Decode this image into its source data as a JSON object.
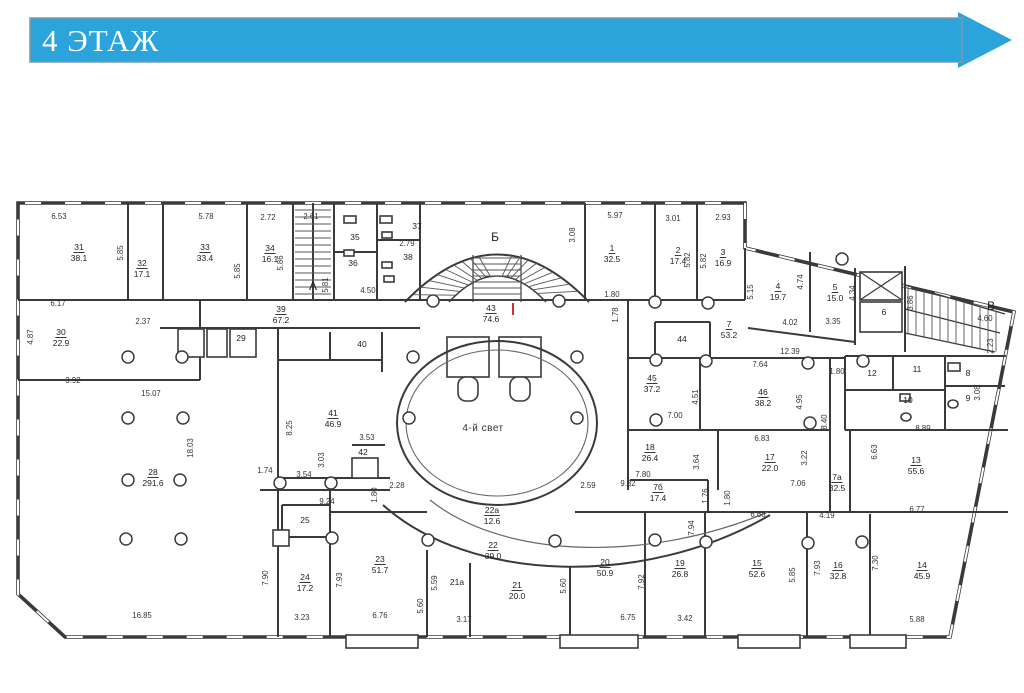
{
  "header": {
    "title": "4 ЭТАЖ",
    "bg_color": "#2AA4DA",
    "border_color": "#7D9AAB",
    "text_color": "#ffffff"
  },
  "plan": {
    "atrium_label": "4-й свет",
    "red_mark": {
      "x": 513,
      "y": 303
    },
    "stairs": [
      {
        "label": "А",
        "x": 313,
        "y": 290
      },
      {
        "label": "Б",
        "x": 495,
        "y": 241
      },
      {
        "label": "В",
        "x": 991,
        "y": 310
      }
    ],
    "rooms": [
      {
        "n": "31",
        "a": "38.1",
        "x": 79,
        "y": 250
      },
      {
        "n": "32",
        "a": "17.1",
        "x": 142,
        "y": 266
      },
      {
        "n": "33",
        "a": "33.4",
        "x": 205,
        "y": 250
      },
      {
        "n": "34",
        "a": "16.1",
        "x": 270,
        "y": 251
      },
      {
        "n": "35",
        "x": 355,
        "y": 240
      },
      {
        "n": "36",
        "x": 353,
        "y": 266
      },
      {
        "n": "37",
        "x": 417,
        "y": 229
      },
      {
        "n": "38",
        "x": 408,
        "y": 260
      },
      {
        "n": "39",
        "a": "67.2",
        "x": 281,
        "y": 312
      },
      {
        "n": "40",
        "x": 362,
        "y": 347
      },
      {
        "n": "41",
        "a": "46.9",
        "x": 333,
        "y": 416
      },
      {
        "n": "42",
        "x": 363,
        "y": 455
      },
      {
        "n": "43",
        "a": "74.6",
        "x": 491,
        "y": 311
      },
      {
        "n": "44",
        "x": 682,
        "y": 342
      },
      {
        "n": "45",
        "a": "37.2",
        "x": 652,
        "y": 381
      },
      {
        "n": "46",
        "a": "38.2",
        "x": 763,
        "y": 395
      },
      {
        "n": "1",
        "a": "32.5",
        "x": 612,
        "y": 251
      },
      {
        "n": "2",
        "a": "17.4",
        "x": 678,
        "y": 253
      },
      {
        "n": "3",
        "a": "16.9",
        "x": 723,
        "y": 255
      },
      {
        "n": "4",
        "a": "19.7",
        "x": 778,
        "y": 289
      },
      {
        "n": "5",
        "a": "15.0",
        "x": 835,
        "y": 290
      },
      {
        "n": "6",
        "x": 884,
        "y": 315
      },
      {
        "n": "7",
        "a": "53.2",
        "x": 729,
        "y": 327
      },
      {
        "n": "7а",
        "a": "32.5",
        "x": 837,
        "y": 480
      },
      {
        "n": "7б",
        "a": "17.4",
        "x": 658,
        "y": 490
      },
      {
        "n": "8",
        "x": 968,
        "y": 376
      },
      {
        "n": "9",
        "x": 968,
        "y": 401
      },
      {
        "n": "10",
        "x": 908,
        "y": 403
      },
      {
        "n": "11",
        "x": 917,
        "y": 372
      },
      {
        "n": "12",
        "x": 872,
        "y": 376
      },
      {
        "n": "13",
        "a": "55.6",
        "x": 916,
        "y": 463
      },
      {
        "n": "14",
        "a": "45.9",
        "x": 922,
        "y": 568
      },
      {
        "n": "15",
        "a": "52.6",
        "x": 757,
        "y": 566
      },
      {
        "n": "16",
        "a": "32.8",
        "x": 838,
        "y": 568
      },
      {
        "n": "17",
        "a": "22.0",
        "x": 770,
        "y": 460
      },
      {
        "n": "18",
        "a": "26.4",
        "x": 650,
        "y": 450
      },
      {
        "n": "19",
        "a": "26.8",
        "x": 680,
        "y": 566
      },
      {
        "n": "20",
        "a": "50.9",
        "x": 605,
        "y": 565
      },
      {
        "n": "21",
        "a": "20.0",
        "x": 517,
        "y": 588
      },
      {
        "n": "21а",
        "x": 457,
        "y": 585
      },
      {
        "n": "22",
        "a": "39.0",
        "x": 493,
        "y": 548
      },
      {
        "n": "22а",
        "a": "12.6",
        "x": 492,
        "y": 513
      },
      {
        "n": "23",
        "a": "51.7",
        "x": 380,
        "y": 562
      },
      {
        "n": "24",
        "a": "17.2",
        "x": 305,
        "y": 580
      },
      {
        "n": "25",
        "x": 305,
        "y": 523
      },
      {
        "n": "28",
        "a": "291.6",
        "x": 153,
        "y": 475
      },
      {
        "n": "29",
        "x": 241,
        "y": 341
      },
      {
        "n": "30",
        "a": "22.9",
        "x": 61,
        "y": 335
      }
    ],
    "dims": [
      {
        "v": "6.53",
        "x": 59,
        "y": 219
      },
      {
        "v": "5.78",
        "x": 206,
        "y": 219
      },
      {
        "v": "2.72",
        "x": 268,
        "y": 220
      },
      {
        "v": "2.61",
        "x": 311,
        "y": 219
      },
      {
        "v": "5.85",
        "x": 123,
        "y": 253,
        "r": 1
      },
      {
        "v": "5.85",
        "x": 240,
        "y": 271,
        "r": 1
      },
      {
        "v": "5.86",
        "x": 283,
        "y": 263,
        "r": 1
      },
      {
        "v": "5.81",
        "x": 328,
        "y": 285,
        "r": 1
      },
      {
        "v": "2.79",
        "x": 407,
        "y": 246
      },
      {
        "v": "4.50",
        "x": 368,
        "y": 293
      },
      {
        "v": "5.97",
        "x": 615,
        "y": 218
      },
      {
        "v": "3.08",
        "x": 575,
        "y": 235,
        "r": 1
      },
      {
        "v": "1.80",
        "x": 612,
        "y": 297
      },
      {
        "v": "1.78",
        "x": 618,
        "y": 315,
        "r": 1
      },
      {
        "v": "3.01",
        "x": 673,
        "y": 221
      },
      {
        "v": "2.93",
        "x": 723,
        "y": 220
      },
      {
        "v": "5.82",
        "x": 690,
        "y": 260,
        "r": 1
      },
      {
        "v": "5.82",
        "x": 706,
        "y": 261,
        "r": 1
      },
      {
        "v": "5.15",
        "x": 753,
        "y": 292,
        "r": 1
      },
      {
        "v": "4.74",
        "x": 803,
        "y": 282,
        "r": 1
      },
      {
        "v": "4.34",
        "x": 855,
        "y": 293,
        "r": 1
      },
      {
        "v": "3.86",
        "x": 913,
        "y": 303,
        "r": 1
      },
      {
        "v": "4.02",
        "x": 790,
        "y": 325
      },
      {
        "v": "3.35",
        "x": 833,
        "y": 324
      },
      {
        "v": "4.60",
        "x": 985,
        "y": 321
      },
      {
        "v": "2.23",
        "x": 993,
        "y": 346,
        "r": 1
      },
      {
        "v": "6.17",
        "x": 58,
        "y": 306
      },
      {
        "v": "2.37",
        "x": 143,
        "y": 324
      },
      {
        "v": "4.87",
        "x": 33,
        "y": 337,
        "r": 1
      },
      {
        "v": "3.92",
        "x": 73,
        "y": 383
      },
      {
        "v": "15.07",
        "x": 151,
        "y": 396
      },
      {
        "v": "18.03",
        "x": 193,
        "y": 448,
        "r": 1
      },
      {
        "v": "8.25",
        "x": 292,
        "y": 428,
        "r": 1
      },
      {
        "v": "1.74",
        "x": 265,
        "y": 473
      },
      {
        "v": "3.53",
        "x": 367,
        "y": 440
      },
      {
        "v": "3.03",
        "x": 324,
        "y": 460,
        "r": 1
      },
      {
        "v": "3.54",
        "x": 304,
        "y": 477
      },
      {
        "v": "2.28",
        "x": 397,
        "y": 488
      },
      {
        "v": "1.80",
        "x": 377,
        "y": 495,
        "r": 1
      },
      {
        "v": "9.24",
        "x": 327,
        "y": 504
      },
      {
        "v": "2.59",
        "x": 588,
        "y": 488
      },
      {
        "v": "16.85",
        "x": 142,
        "y": 618
      },
      {
        "v": "7.90",
        "x": 268,
        "y": 578,
        "r": 1
      },
      {
        "v": "3.23",
        "x": 302,
        "y": 620
      },
      {
        "v": "7.93",
        "x": 342,
        "y": 580,
        "r": 1
      },
      {
        "v": "6.76",
        "x": 380,
        "y": 618
      },
      {
        "v": "5.59",
        "x": 437,
        "y": 583,
        "r": 1
      },
      {
        "v": "5.60",
        "x": 423,
        "y": 606,
        "r": 1
      },
      {
        "v": "3.17",
        "x": 464,
        "y": 622
      },
      {
        "v": "5.60",
        "x": 566,
        "y": 586,
        "r": 1
      },
      {
        "v": "6.75",
        "x": 628,
        "y": 620
      },
      {
        "v": "3.42",
        "x": 685,
        "y": 621
      },
      {
        "v": "7.92",
        "x": 644,
        "y": 582,
        "r": 1
      },
      {
        "v": "7.94",
        "x": 694,
        "y": 528,
        "r": 1
      },
      {
        "v": "9.82",
        "x": 628,
        "y": 486
      },
      {
        "v": "7.80",
        "x": 643,
        "y": 477
      },
      {
        "v": "7.06",
        "x": 798,
        "y": 486
      },
      {
        "v": "1.76",
        "x": 708,
        "y": 496,
        "r": 1
      },
      {
        "v": "1.80",
        "x": 730,
        "y": 498,
        "r": 1
      },
      {
        "v": "6.68",
        "x": 758,
        "y": 517
      },
      {
        "v": "4.19",
        "x": 827,
        "y": 518
      },
      {
        "v": "6.77",
        "x": 917,
        "y": 512
      },
      {
        "v": "5.85",
        "x": 795,
        "y": 575,
        "r": 1
      },
      {
        "v": "7.93",
        "x": 820,
        "y": 568,
        "r": 1
      },
      {
        "v": "7.30",
        "x": 878,
        "y": 563,
        "r": 1
      },
      {
        "v": "5.88",
        "x": 917,
        "y": 622
      },
      {
        "v": "7.00",
        "x": 675,
        "y": 418
      },
      {
        "v": "6.83",
        "x": 762,
        "y": 441
      },
      {
        "v": "3.22",
        "x": 807,
        "y": 458,
        "r": 1
      },
      {
        "v": "3.64",
        "x": 699,
        "y": 462,
        "r": 1
      },
      {
        "v": "4.51",
        "x": 698,
        "y": 397,
        "r": 1
      },
      {
        "v": "4.95",
        "x": 802,
        "y": 402,
        "r": 1
      },
      {
        "v": "8.40",
        "x": 827,
        "y": 422,
        "r": 1
      },
      {
        "v": "12.39",
        "x": 790,
        "y": 354
      },
      {
        "v": "7.64",
        "x": 760,
        "y": 367
      },
      {
        "v": "1.80",
        "x": 837,
        "y": 374
      },
      {
        "v": "6.63",
        "x": 877,
        "y": 452,
        "r": 1
      },
      {
        "v": "8.89",
        "x": 923,
        "y": 431
      },
      {
        "v": "3.08",
        "x": 980,
        "y": 393,
        "r": 1
      }
    ]
  }
}
